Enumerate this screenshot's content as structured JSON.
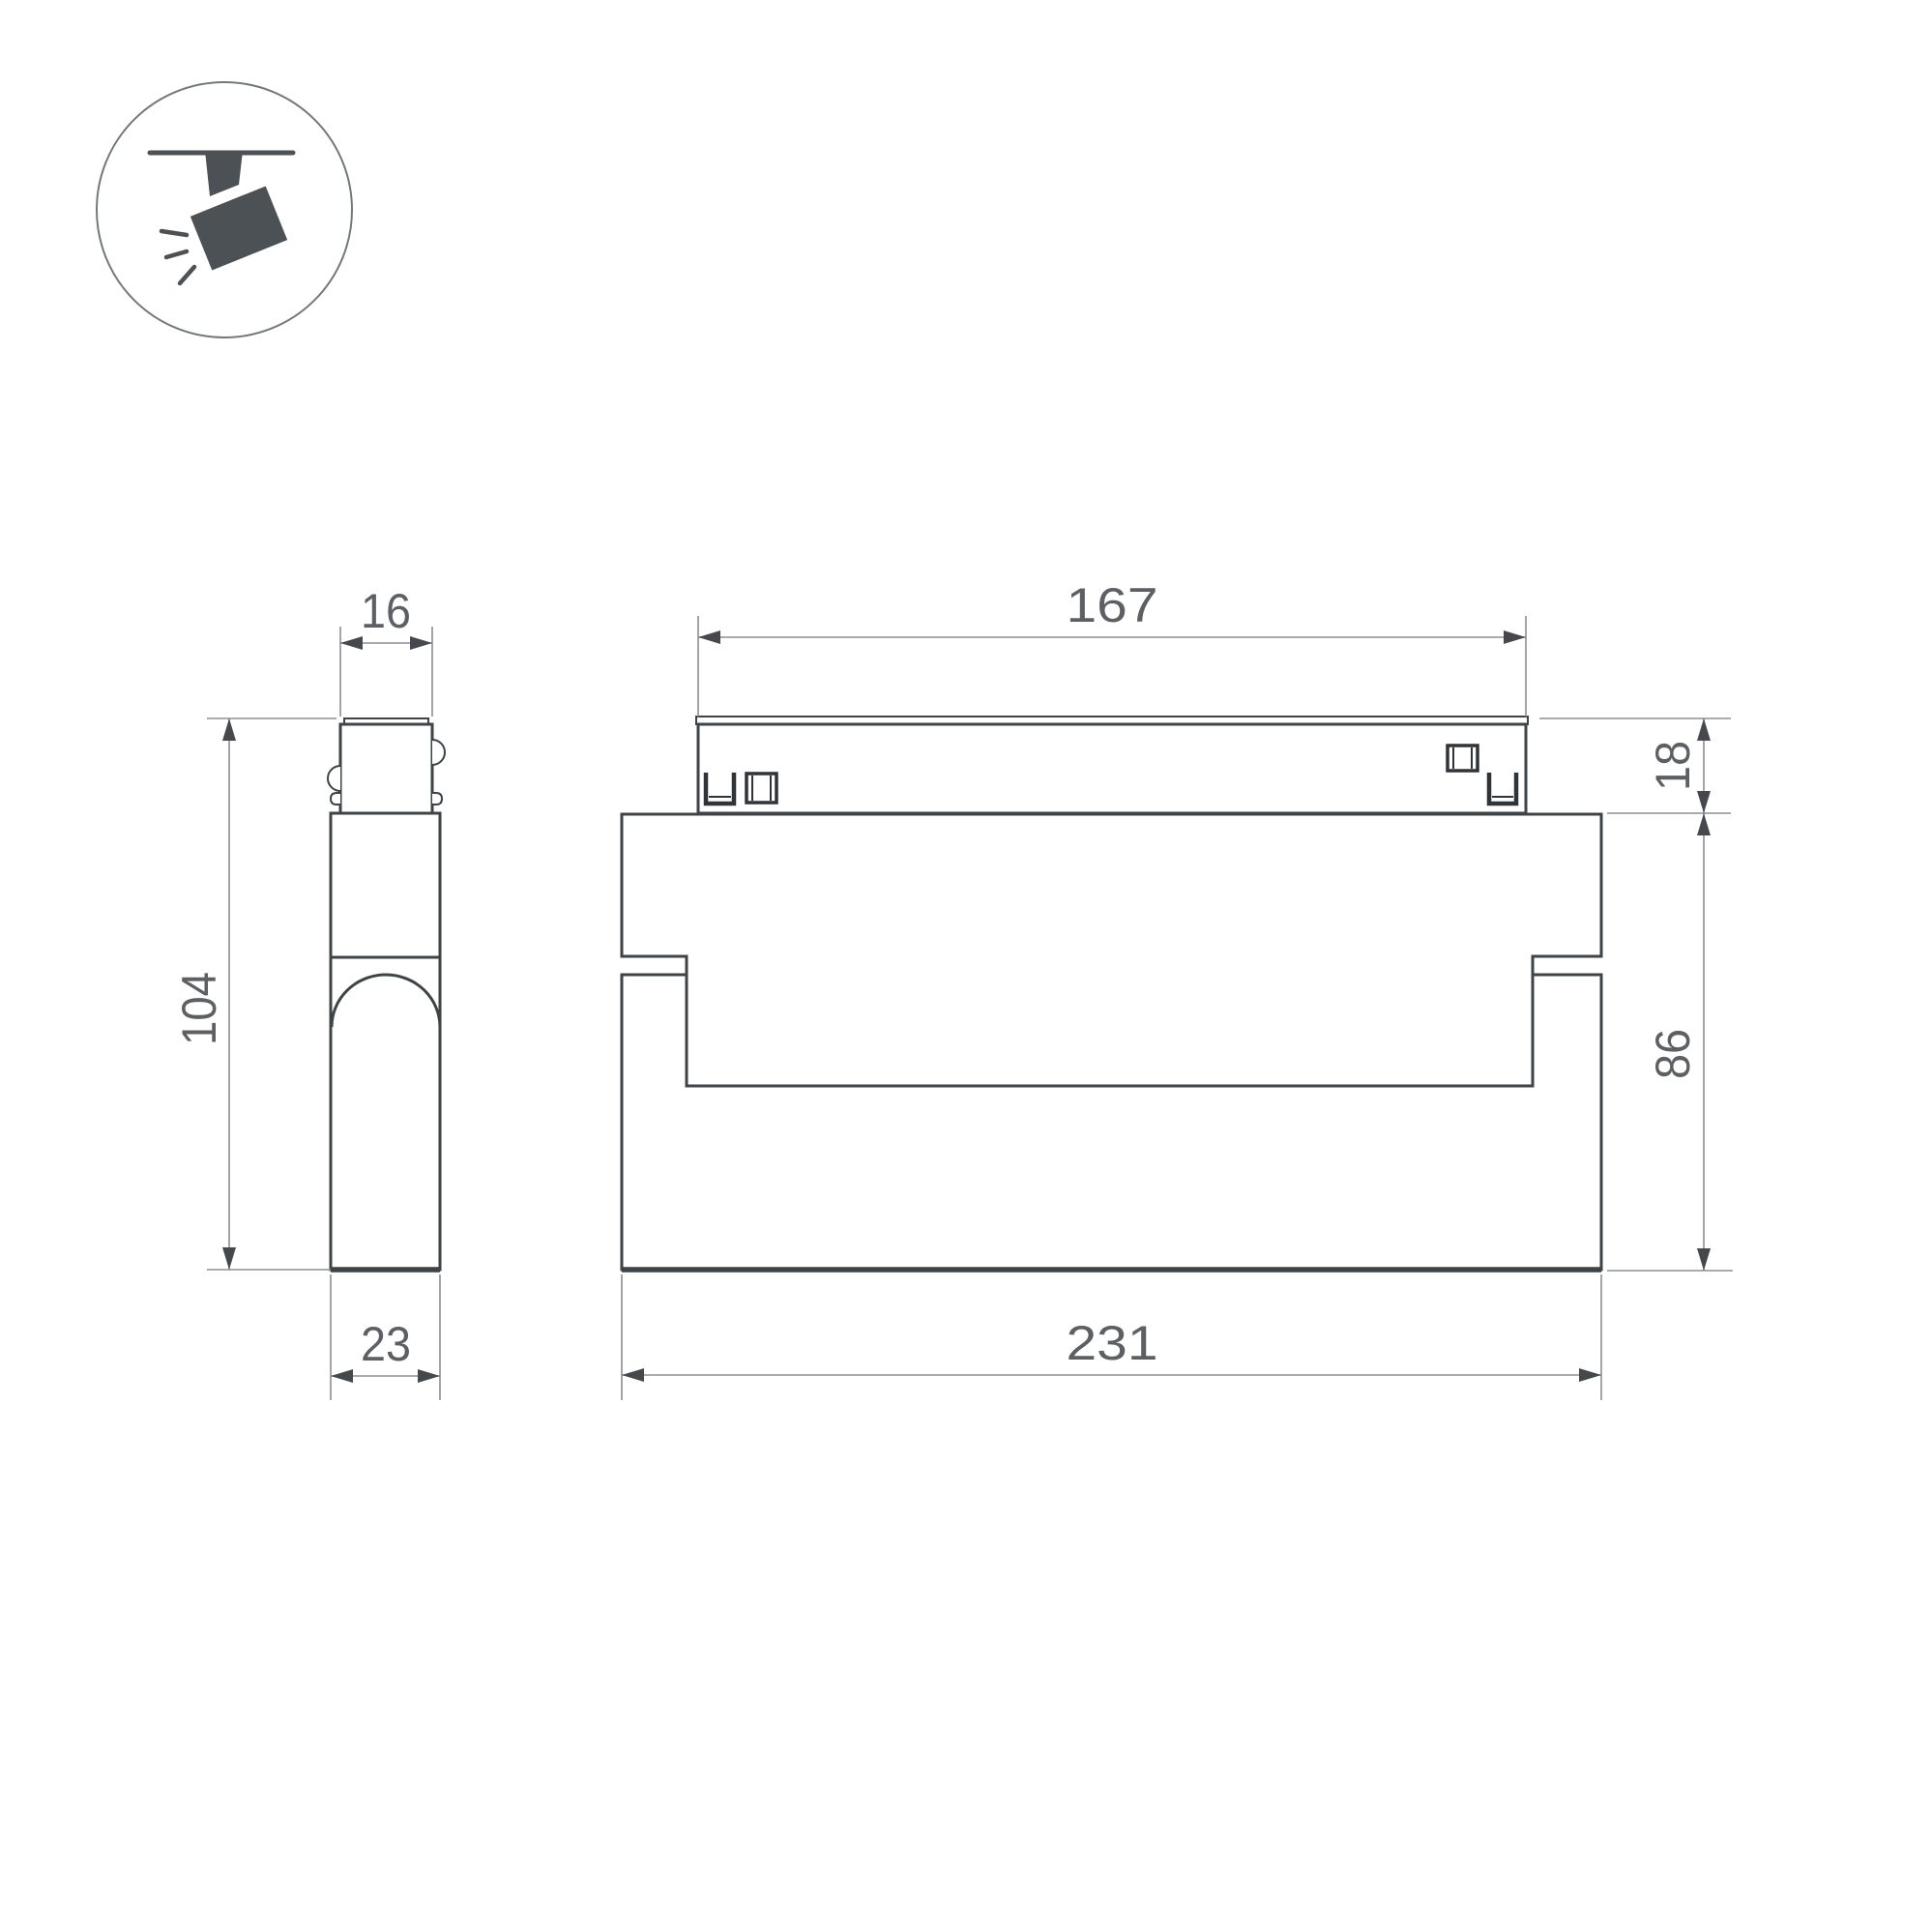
{
  "icon": {
    "name": "ceiling-track-spotlight"
  },
  "dims": {
    "front_top_width": "167",
    "front_top_height": "18",
    "front_body_height": "86",
    "front_total_width": "231",
    "side_top_width": "16",
    "side_total_height": "104",
    "side_bottom_width": "23"
  },
  "colors": {
    "background": "#ffffff",
    "object_line": "#3e4347",
    "dimension_line": "#8b9094",
    "dimension_text": "#5c6064",
    "arrow": "#45494d",
    "icon_fill": "#4b5154",
    "icon_circle_stroke": "#73787c"
  }
}
